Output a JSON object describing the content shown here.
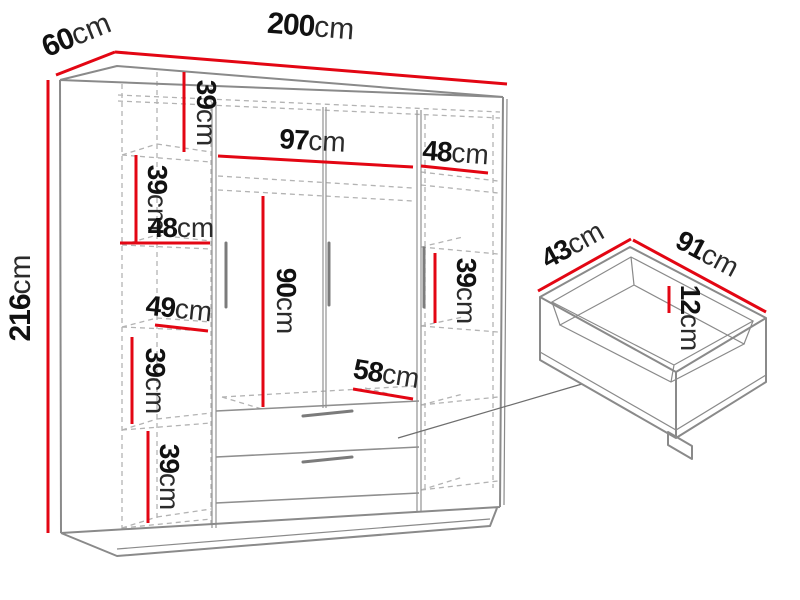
{
  "colors": {
    "dimension_line": "#e30613",
    "outline": "#8a8a8a",
    "hidden_edge": "#b3b3b3",
    "label_text": "#111111",
    "background": "#ffffff"
  },
  "wardrobe": {
    "width": {
      "value": "200",
      "unit": "cm"
    },
    "depth": {
      "value": "60",
      "unit": "cm"
    },
    "height": {
      "value": "216",
      "unit": "cm"
    },
    "left_column": {
      "shelf_1_height": {
        "value": "39",
        "unit": "cm"
      },
      "shelf_2_height": {
        "value": "39",
        "unit": "cm"
      },
      "inner_width": {
        "value": "48",
        "unit": "cm"
      },
      "inner_width_lower": {
        "value": "49",
        "unit": "cm"
      },
      "shelf_4_height": {
        "value": "39",
        "unit": "cm"
      },
      "shelf_5_height": {
        "value": "39",
        "unit": "cm"
      }
    },
    "middle_section": {
      "inner_width": {
        "value": "97",
        "unit": "cm"
      },
      "hanging_height": {
        "value": "90",
        "unit": "cm"
      },
      "bottom_depth": {
        "value": "58",
        "unit": "cm"
      }
    },
    "right_column": {
      "inner_width": {
        "value": "48",
        "unit": "cm"
      },
      "shelf_height": {
        "value": "39",
        "unit": "cm"
      }
    }
  },
  "drawer": {
    "depth": {
      "value": "43",
      "unit": "cm"
    },
    "width": {
      "value": "91",
      "unit": "cm"
    },
    "height": {
      "value": "12",
      "unit": "cm"
    }
  }
}
